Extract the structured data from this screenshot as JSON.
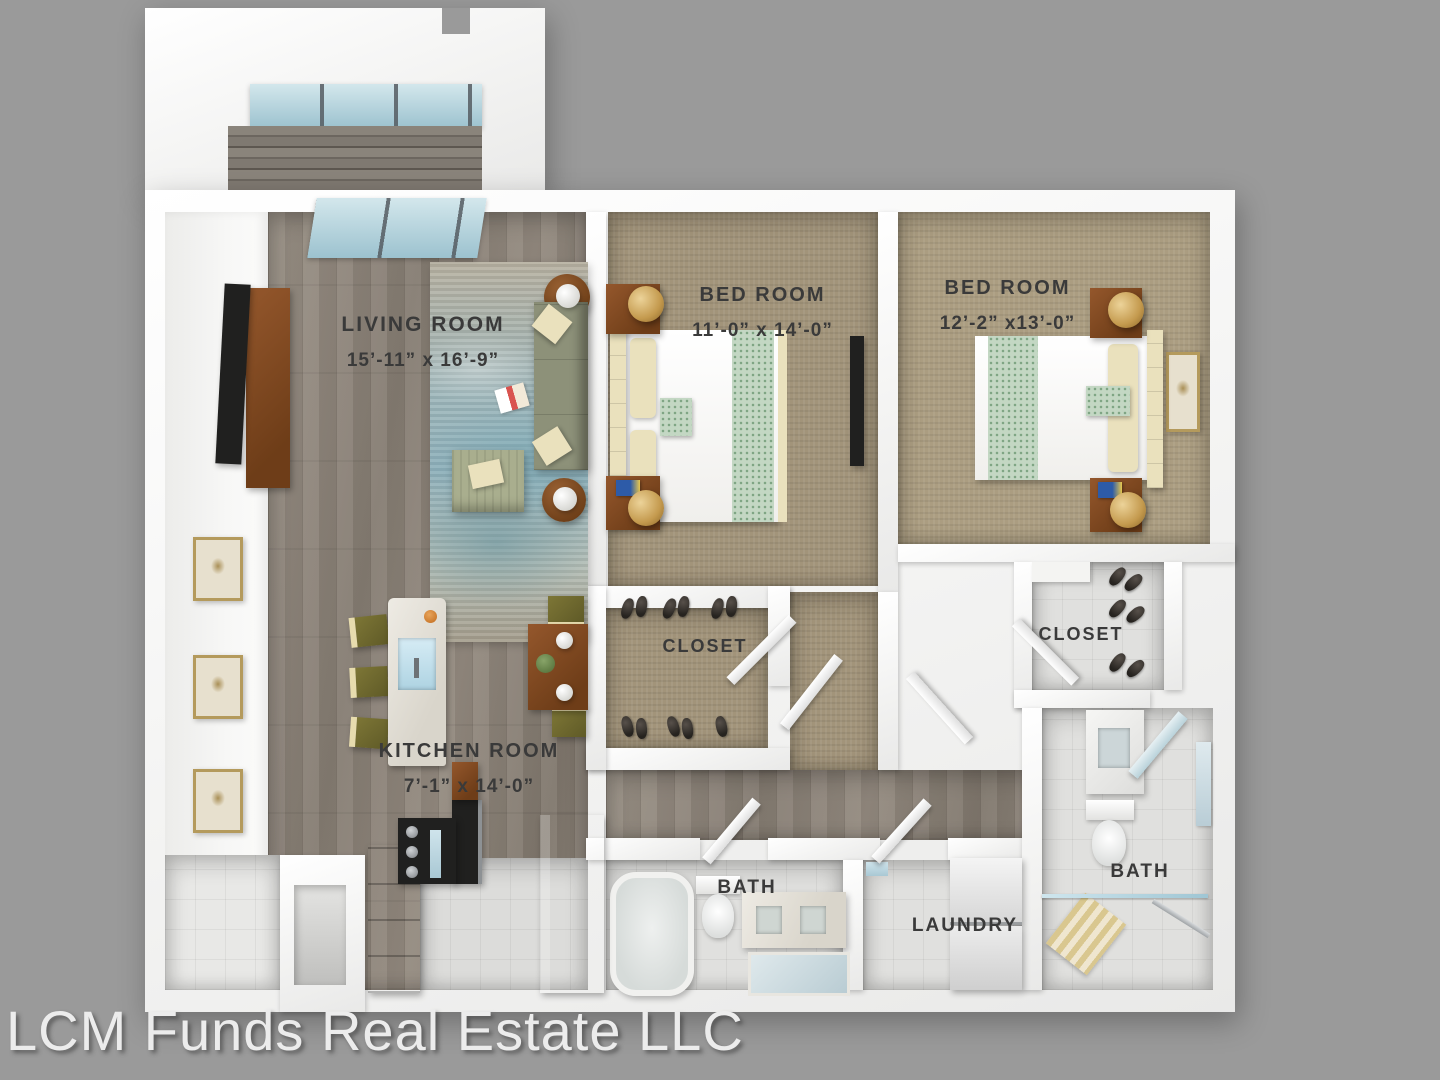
{
  "image_type": "3d-rendered-floor-plan",
  "watermark": "LCM Funds Real Estate LLC",
  "rooms": {
    "living_room": {
      "label": "LIVING ROOM",
      "dimensions": "15’-11” x 16’-9”"
    },
    "bedroom_1": {
      "label": "BED ROOM",
      "dimensions": "11’-0” x 14’-0”"
    },
    "bedroom_2": {
      "label": "BED ROOM",
      "dimensions": "12’-2” x13’-0”"
    },
    "kitchen": {
      "label": "KITCHEN ROOM",
      "dimensions": "7’-1” x 14’-0”"
    },
    "closet_1": {
      "label": "CLOSET"
    },
    "closet_2": {
      "label": "CLOSET"
    },
    "bath_1": {
      "label": "BATH"
    },
    "bath_2": {
      "label": "BATH"
    },
    "laundry": {
      "label": "LAUNDRY"
    }
  },
  "colors": {
    "background": "#9a9a9a",
    "walls": "#f5f5f4",
    "wood_floor": "#8d847a",
    "carpet": "#a2947a",
    "tile": "#e0e0de",
    "rug_teal": "#8fb0ba",
    "sofa_green": "#8d9179",
    "furniture_wood": "#80502a",
    "glass": "#bcd9e2",
    "label_text": "#3a3a3a",
    "watermark_text": "#ececec"
  }
}
